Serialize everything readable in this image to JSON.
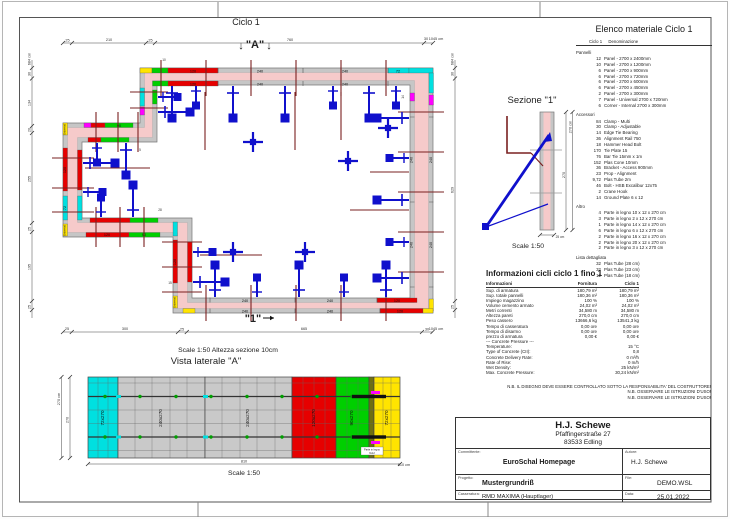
{
  "plan": {
    "title": "Ciclo 1",
    "marker_a": "\"A\"",
    "marker_1": "\"1\"",
    "arrow_down": "↓",
    "scale_note": "Scale 1:50   Altezza sezione 10cm",
    "dims_top": [
      "25",
      "210",
      "25",
      "760",
      "30",
      "1045 cm"
    ],
    "dims_left": [
      "684 cm",
      "30",
      "134",
      "20",
      "255",
      "25",
      "195",
      "25"
    ],
    "dims_right": [
      "684 cm",
      "30",
      "629",
      "25"
    ],
    "dims_bottom": [
      "25",
      "300",
      "25",
      "665",
      "30",
      "1045 cm"
    ],
    "panel_240": "240",
    "panel_120": "120",
    "panel_90": "90",
    "panel_72": "72",
    "panel_universal": "Universal",
    "tiny": [
      "10",
      "14",
      "28",
      "15",
      "5"
    ]
  },
  "sezione": {
    "title": "Sezione \"1\"",
    "scale": "Scale 1:50",
    "dim_total": "270 cm",
    "dim_inner": "270",
    "dim_width": "25 cm"
  },
  "elevation": {
    "title": "Vista laterale \"A\"",
    "scale": "Scale 1:50",
    "dim_height_total": "270 cm",
    "dim_height": "270",
    "dim_width": "810",
    "dim_width_total": "810 cm",
    "panels": [
      "72x270",
      "240x270",
      "240x270",
      "120x270",
      "90x270",
      "72x270"
    ],
    "wood_label_1": "Parte in legno",
    "wood_label_2": "6x12"
  },
  "material_list": {
    "title": "Elenco materiale  Ciclo 1",
    "col_qty": "Ciclo 1",
    "col_name": "Denominazione",
    "groups": [
      {
        "name": "Pannelli",
        "items": [
          {
            "q": "12",
            "n": "Panel - 2700 x 2400mm"
          },
          {
            "q": "10",
            "n": "Panel - 2700 x 1200mm"
          },
          {
            "q": "6",
            "n": "Panel - 2700 x 900mm"
          },
          {
            "q": "6",
            "n": "Panel - 2700 x 720mm"
          },
          {
            "q": "6",
            "n": "Panel - 2700 x 600mm"
          },
          {
            "q": "6",
            "n": "Panel - 2700 x 450mm"
          },
          {
            "q": "2",
            "n": "Panel - 2700 x 300mm"
          },
          {
            "q": "7",
            "n": "Panel - Universal 2700 x 720mm"
          },
          {
            "q": "6",
            "n": "Corner - Internal 2700 x 300mm"
          }
        ]
      },
      {
        "name": "Accessori",
        "items": [
          {
            "q": "84",
            "n": "Clamp - Multi"
          },
          {
            "q": "30",
            "n": "Clamp - Adjustable"
          },
          {
            "q": "14",
            "n": "Edge Tie Bearing"
          },
          {
            "q": "36",
            "n": "Alignment Rail 750"
          },
          {
            "q": "18",
            "n": "Hammer Head Bolt"
          },
          {
            "q": "170",
            "n": "Tie Plate 15"
          },
          {
            "q": "76",
            "n": "Bar Tie 15mm x 1m"
          },
          {
            "q": "152",
            "n": "Plas Cone 10mm"
          },
          {
            "q": "36",
            "n": "Bracket - Access 900mm"
          },
          {
            "q": "23",
            "n": "Prop - Alignment"
          },
          {
            "q": "9,72",
            "n": "Plas Tube 2m"
          },
          {
            "q": "46",
            "n": "Bolt - HSB Excalibur 12x75"
          },
          {
            "q": "2",
            "n": "Crane Hook"
          },
          {
            "q": "14",
            "n": "Ground Plate 6 x 12"
          }
        ]
      },
      {
        "name": "Altro",
        "items": [
          {
            "q": "4",
            "n": "Parte in legno 10 x 12 x 270 cm"
          },
          {
            "q": "3",
            "n": "Parte in legno 2 x 12 x 270 cm"
          },
          {
            "q": "1",
            "n": "Parte in legno 14 x 12 x 270 cm"
          },
          {
            "q": "6",
            "n": "Parte in legno 6 x 12 x 270 cm"
          },
          {
            "q": "2",
            "n": "Parte in legno 16 x 12 x 270 cm"
          },
          {
            "q": "2",
            "n": "Parte in legno 20 x 12 x 270 cm"
          },
          {
            "q": "2",
            "n": "Parte in legno 3 x 12 x 270 cm"
          }
        ]
      },
      {
        "name": "Lista dettagliata",
        "items": [
          {
            "q": "32",
            "n": "Plas Tube  (28 cm)"
          },
          {
            "q": "32",
            "n": "Plas Tube  (23 cm)"
          },
          {
            "q": "12",
            "n": "Plas Tube  (18 cm)"
          }
        ]
      }
    ]
  },
  "info": {
    "title": "Informazioni cicli  ciclo 1 fino 1",
    "col_info": "Informazioni",
    "col_fornitura": "Fornitura",
    "col_ciclo": "Ciclo 1",
    "rows": [
      {
        "l": "Sup. di armatura",
        "f": "180,79 m²",
        "c": "180,79 m²"
      },
      {
        "l": "Sup. totale pannelli",
        "f": "180,36 m²",
        "c": "180,36 m²"
      },
      {
        "l": "Impiego magazzino",
        "f": "100 %",
        "c": "100 %"
      },
      {
        "l": "Volume cemento armato",
        "f": "24,02 m³",
        "c": "24,02 m³"
      },
      {
        "l": "Metri correnti",
        "f": "34,580 m",
        "c": "34,580 m"
      },
      {
        "l": "Altezza pareti",
        "f": "270,0 cm",
        "c": "270,0 cm"
      },
      {
        "l": "Peso cassero",
        "f": "13666,6 kg",
        "c": "13541,3 kg"
      },
      {
        "l": "Tempo di casseratura",
        "f": "0,00 ore",
        "c": "0,00 ore"
      },
      {
        "l": "Tempo di disarmo",
        "f": "0,00 ore",
        "c": "0,00 ore"
      },
      {
        "l": "prezzo di armatura",
        "f": "0,00 €",
        "c": "0,00 €"
      },
      {
        "l": "--- Concrete Pressure ---",
        "f": "",
        "c": ""
      },
      {
        "l": "Temperature:",
        "f": "",
        "c": "15 °C"
      },
      {
        "l": "Type of Concrete (CII):",
        "f": "",
        "c": "0,8"
      },
      {
        "l": "Concrete Delivery Rate:",
        "f": "",
        "c": "0 m³/h"
      },
      {
        "l": "Rate of Rise:",
        "f": "",
        "c": "0 m/h"
      },
      {
        "l": "Wet Density:",
        "f": "",
        "c": "25 kN/m³"
      },
      {
        "l": "Max. Concrete Pressure:",
        "f": "",
        "c": "30,24 kN/m²"
      }
    ]
  },
  "notes": [
    "N.B. IL DISEGNO DEVE ESSERE CONTROLLATO SOTTO LA RESPONSABILITA' DEL COSTRUTTORE!",
    "N.B. OSSERVARE LE ISTRUZIONI D'USO!",
    "N.B. OSSERVARE LE ISTRUZIONI D'USO!"
  ],
  "titleblock": {
    "company": "H.J. Schewe",
    "street": "Pfaffingerstraße 27",
    "city": "83533 Edling",
    "label_committente": "Committente:",
    "committente": "EuroSchal Homepage",
    "label_autore": "Autore:",
    "autore": "H.J. Schewe",
    "label_progetto": "Progetto:",
    "progetto": "Mustergrundriß",
    "label_file": "File:",
    "file": "DEMO.WSL",
    "label_casseratura": "Casseratura:",
    "casseratura": "RMD MAXIMA (Hauptlager)",
    "label_data": "Data:",
    "data": "25.01.2022"
  },
  "colors": {
    "pink": "#f6caca",
    "panel_gray": "#c6c6c6",
    "red": "#e60000",
    "green": "#00cf00",
    "cyan": "#00e0e0",
    "yellow": "#ffe400",
    "magenta": "#ff00ff",
    "blue": "#1010cc",
    "brown": "#7a2020",
    "olive": "#6f6f12"
  }
}
